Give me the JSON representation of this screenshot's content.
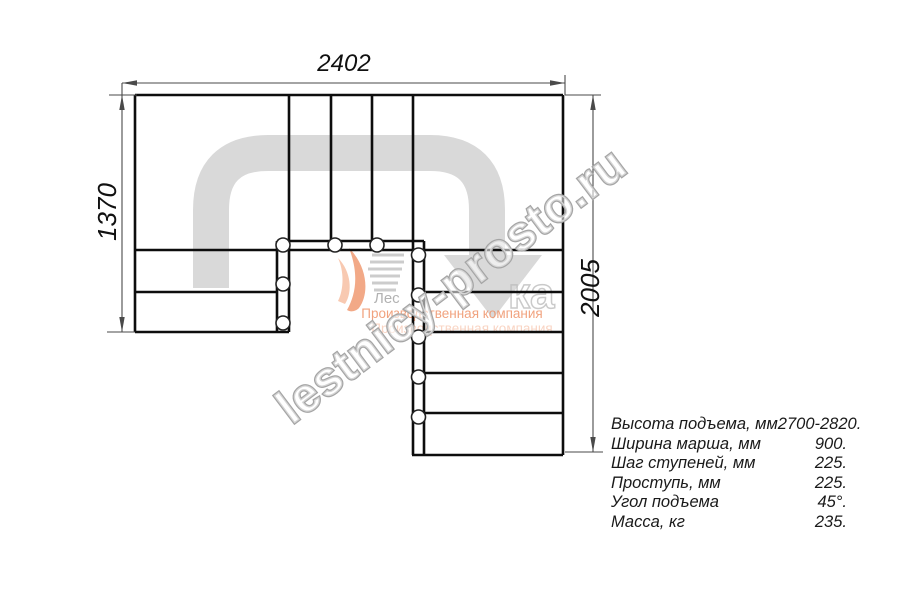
{
  "dimensions": {
    "top": "2402",
    "left": "1370",
    "right": "2005"
  },
  "watermark": {
    "text": "lestnicy-prosto.ru",
    "color": "#a5a5a5"
  },
  "logo": {
    "fragment": "Лес",
    "fragment2": "ка",
    "tagline1": "Производственная компания",
    "tagline2": "Производственная компания",
    "accent_color": "#ee8c5f"
  },
  "drawing": {
    "arrow_color": "#d9d9d9",
    "line_color": "#0d0d0d"
  },
  "specs": {
    "rows": [
      {
        "label": "Высота подъема, мм",
        "value": "2700-2820."
      },
      {
        "label": "Ширина марша, мм",
        "value": "900."
      },
      {
        "label": "Шаг ступеней, мм",
        "value": "225."
      },
      {
        "label": "Проступь, мм",
        "value": "225."
      },
      {
        "label": "Угол подъема",
        "value": "45°."
      },
      {
        "label": "Масса, кг",
        "value": "235."
      }
    ]
  }
}
